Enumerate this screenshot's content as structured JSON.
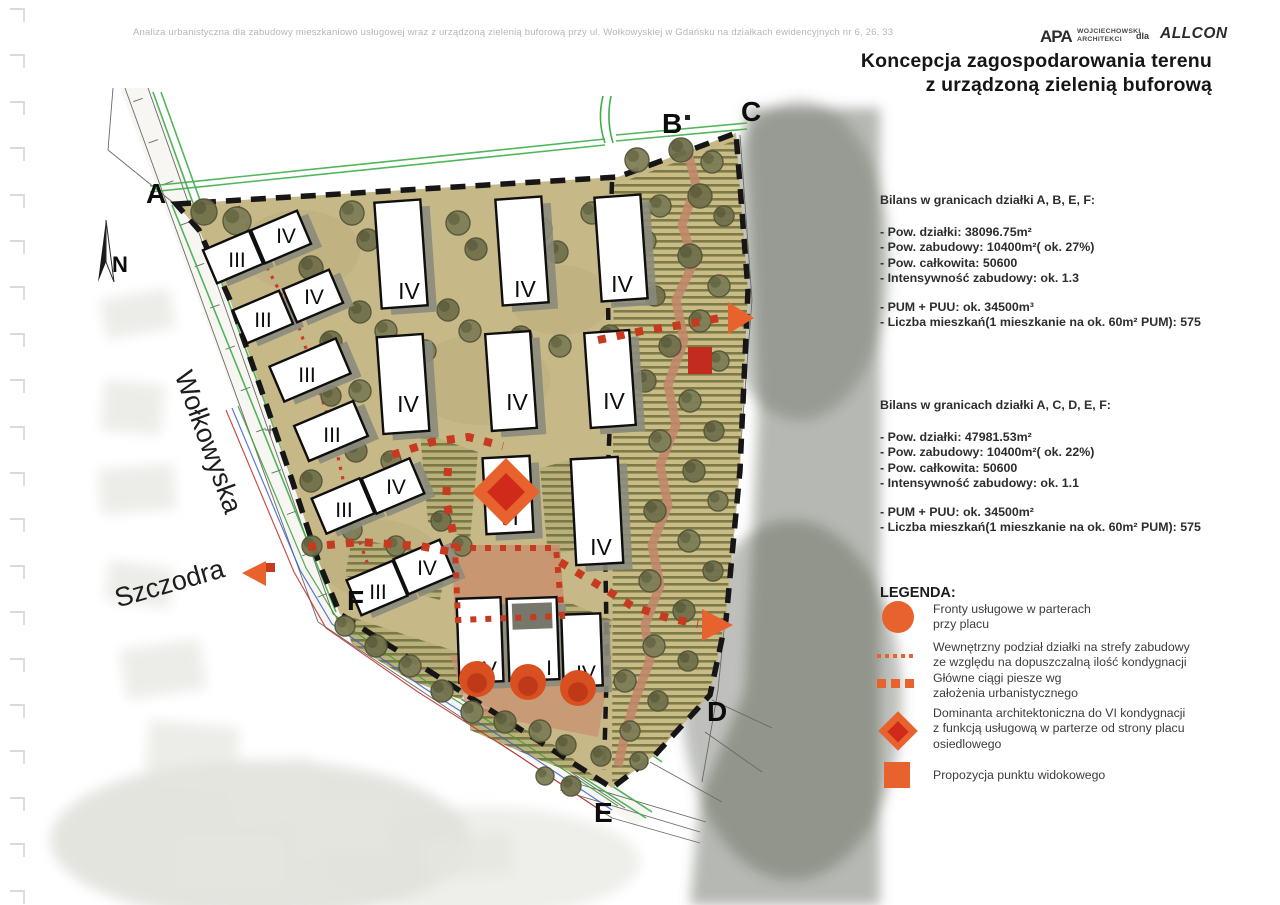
{
  "page": {
    "header_line": "Analiza urbanistyczna dla zabudowy mieszkaniowo usługowej wraz z urządzoną zielenią buforową przy ul. Wołkowyskiej w Gdańsku na działkach ewidencyjnych nr 6, 26, 33",
    "title_line1": "Koncepcja zagospodarowania terenu",
    "title_line2": "z urządzoną zielenią buforową"
  },
  "logos": {
    "apa_mark": "APA",
    "apa_name_line1": "WOJCIECHOWSKI",
    "apa_name_line2": "ARCHITEKCI",
    "dla": "dla",
    "allcon": "ALLCON"
  },
  "bilans_abef": {
    "heading": "Bilans w granicach działki A, B, E, F:",
    "lines1": [
      "- Pow. działki: 38096.75m²",
      "- Pow. zabudowy: 10400m²( ok. 27%)",
      "- Pow. całkowita: 50600",
      "- Intensywność zabudowy: ok. 1.3"
    ],
    "lines2": [
      "- PUM + PUU: ok. 34500m³",
      "- Liczba mieszkań(1 mieszkanie na ok. 60m² PUM): 575"
    ]
  },
  "bilans_acdef": {
    "heading": "Bilans w granicach działki A, C, D, E, F:",
    "lines1": [
      "- Pow. działki: 47981.53m²",
      "- Pow. zabudowy: 10400m²( ok. 22%)",
      "- Pow. całkowita: 50600",
      "- Intensywność zabudowy: ok. 1.1"
    ],
    "lines2": [
      "- PUM + PUU: ok. 34500m²",
      "- Liczba mieszkań(1 mieszkanie na ok. 60m² PUM): 575"
    ]
  },
  "legend": {
    "heading": "LEGENDA:",
    "items": [
      {
        "icon": "service-front-circle-icon",
        "text": "Fronty usługowe w parterach\nprzy placu"
      },
      {
        "icon": "zone-division-dotted-icon",
        "text": "Wewnętrzny podział działki na strefy zabudowy\nze względu na dopuszczalną ilość kondygnacji"
      },
      {
        "icon": "pedestrian-route-dashed-icon",
        "text": "Główne ciągi piesze wg\nzałożenia urbanistycznego"
      },
      {
        "icon": "architectural-dominant-diamond-icon",
        "text": "Dominanta architektoniczna do VI kondygnacji\nz funkcją usługową w parterze od strony placu\nosiedlowego"
      },
      {
        "icon": "viewpoint-square-icon",
        "text": "Propozycja punktu widokowego"
      }
    ]
  },
  "colors": {
    "accent_orange": "#e8622d",
    "accent_red": "#cf2a1a",
    "path_red": "#c63a20",
    "site_tan": "#c7b888",
    "buffer_tan": "#c9bd85",
    "hatch_olive": "#6f6e3e",
    "shadow_gray": "#8b8b7d",
    "tree_dark": "#71714d",
    "tree_light": "#7e7e57",
    "salmon": "#c1876a",
    "green_line": "#3fae4a",
    "boundary_black": "#161616"
  },
  "map": {
    "north_label": "N",
    "plot_labels": [
      {
        "text": "A",
        "x": 146,
        "y": 203
      },
      {
        "text": "B",
        "x": 662,
        "y": 133
      },
      {
        "text": "C",
        "x": 741,
        "y": 121
      },
      {
        "text": "D",
        "x": 707,
        "y": 721
      },
      {
        "text": "E",
        "x": 594,
        "y": 822
      },
      {
        "text": "F",
        "x": 347,
        "y": 610
      }
    ],
    "street_labels": [
      {
        "text": "Wołkowyska",
        "x": 200,
        "y": 445,
        "rot": 70
      },
      {
        "text": "Szczodra",
        "x": 172,
        "y": 592,
        "rot": -16
      }
    ],
    "buildings": [
      {
        "cx": 233,
        "cy": 257,
        "w": 50,
        "h": 36,
        "rot": -23,
        "label": "III",
        "lx": 237,
        "ly": 267,
        "fs": 21
      },
      {
        "cx": 281,
        "cy": 237,
        "w": 50,
        "h": 36,
        "rot": -23,
        "label": "IV",
        "lx": 286,
        "ly": 243,
        "fs": 21
      },
      {
        "cx": 263,
        "cy": 317,
        "w": 50,
        "h": 36,
        "rot": -23,
        "label": "III",
        "lx": 263,
        "ly": 327,
        "fs": 21
      },
      {
        "cx": 313,
        "cy": 296,
        "w": 50,
        "h": 36,
        "rot": -23,
        "label": "IV",
        "lx": 314,
        "ly": 304,
        "fs": 21
      },
      {
        "cx": 310,
        "cy": 370,
        "w": 72,
        "h": 38,
        "rot": -23,
        "label": "III",
        "lx": 307,
        "ly": 382,
        "fs": 21
      },
      {
        "cx": 331,
        "cy": 431,
        "w": 64,
        "h": 38,
        "rot": -23,
        "label": "III",
        "lx": 332,
        "ly": 442,
        "fs": 21
      },
      {
        "cx": 343,
        "cy": 506,
        "w": 52,
        "h": 38,
        "rot": -23,
        "label": "III",
        "lx": 344,
        "ly": 517,
        "fs": 21
      },
      {
        "cx": 393,
        "cy": 486,
        "w": 52,
        "h": 38,
        "rot": -23,
        "label": "IV",
        "lx": 396,
        "ly": 494,
        "fs": 21
      },
      {
        "cx": 377,
        "cy": 588,
        "w": 50,
        "h": 38,
        "rot": -23,
        "label": "III",
        "lx": 378,
        "ly": 599,
        "fs": 21
      },
      {
        "cx": 424,
        "cy": 567,
        "w": 50,
        "h": 38,
        "rot": -23,
        "label": "IV",
        "lx": 427,
        "ly": 575,
        "fs": 21
      },
      {
        "cx": 401,
        "cy": 254,
        "w": 46,
        "h": 106,
        "rot": -4,
        "label": "IV",
        "lx": 409,
        "ly": 299,
        "fs": 23
      },
      {
        "cx": 522,
        "cy": 251,
        "w": 46,
        "h": 106,
        "rot": -4,
        "label": "IV",
        "lx": 525,
        "ly": 297,
        "fs": 23
      },
      {
        "cx": 621,
        "cy": 248,
        "w": 46,
        "h": 104,
        "rot": -4,
        "label": "IV",
        "lx": 622,
        "ly": 292,
        "fs": 23
      },
      {
        "cx": 403,
        "cy": 384,
        "w": 46,
        "h": 97,
        "rot": -4,
        "label": "IV",
        "lx": 408,
        "ly": 412,
        "fs": 23
      },
      {
        "cx": 511,
        "cy": 381,
        "w": 45,
        "h": 97,
        "rot": -4,
        "label": "IV",
        "lx": 517,
        "ly": 410,
        "fs": 23
      },
      {
        "cx": 610,
        "cy": 379,
        "w": 45,
        "h": 95,
        "rot": -4,
        "label": "IV",
        "lx": 614,
        "ly": 409,
        "fs": 23
      },
      {
        "cx": 508,
        "cy": 495,
        "w": 47,
        "h": 76,
        "rot": -3,
        "label": "VI",
        "lx": 508,
        "ly": 525,
        "fs": 23
      },
      {
        "cx": 597,
        "cy": 511,
        "w": 47,
        "h": 106,
        "rot": -3,
        "label": "IV",
        "lx": 601,
        "ly": 555,
        "fs": 23
      },
      {
        "cx": 480,
        "cy": 640,
        "w": 44,
        "h": 84,
        "rot": -2,
        "label": "IV",
        "lx": 487,
        "ly": 676,
        "fs": 21
      },
      {
        "cx": 533,
        "cy": 639,
        "w": 50,
        "h": 82,
        "rot": -2,
        "label": "I",
        "lx": 549,
        "ly": 675,
        "fs": 21,
        "court": true
      },
      {
        "cx": 582,
        "cy": 650,
        "w": 39,
        "h": 72,
        "rot": -2,
        "label": "IV",
        "lx": 586,
        "ly": 680,
        "fs": 21
      }
    ],
    "trees": [
      [
        204,
        212,
        13
      ],
      [
        237,
        221,
        14
      ],
      [
        251,
        247,
        12
      ],
      [
        352,
        213,
        12
      ],
      [
        368,
        240,
        11
      ],
      [
        458,
        223,
        12
      ],
      [
        476,
        249,
        11
      ],
      [
        540,
        229,
        12
      ],
      [
        557,
        252,
        11
      ],
      [
        592,
        213,
        11
      ],
      [
        311,
        268,
        12
      ],
      [
        323,
        300,
        11
      ],
      [
        360,
        312,
        11
      ],
      [
        386,
        331,
        11
      ],
      [
        448,
        310,
        11
      ],
      [
        470,
        331,
        11
      ],
      [
        331,
        342,
        11
      ],
      [
        425,
        351,
        11
      ],
      [
        521,
        337,
        11
      ],
      [
        560,
        346,
        11
      ],
      [
        610,
        336,
        11
      ],
      [
        360,
        391,
        11
      ],
      [
        331,
        396,
        10
      ],
      [
        396,
        420,
        11
      ],
      [
        356,
        451,
        11
      ],
      [
        391,
        461,
        10
      ],
      [
        311,
        481,
        11
      ],
      [
        352,
        530,
        10
      ],
      [
        312,
        546,
        10
      ],
      [
        396,
        546,
        10
      ],
      [
        441,
        521,
        10
      ],
      [
        462,
        546,
        10
      ],
      [
        432,
        571,
        10
      ],
      [
        345,
        626,
        10
      ],
      [
        376,
        646,
        11
      ],
      [
        410,
        666,
        11
      ],
      [
        442,
        691,
        11
      ],
      [
        472,
        712,
        11
      ],
      [
        505,
        722,
        11
      ],
      [
        540,
        731,
        11
      ],
      [
        566,
        745,
        10
      ],
      [
        637,
        160,
        12
      ],
      [
        681,
        150,
        12
      ],
      [
        712,
        162,
        11
      ],
      [
        700,
        196,
        12
      ],
      [
        660,
        206,
        11
      ],
      [
        724,
        216,
        10
      ],
      [
        645,
        241,
        11
      ],
      [
        690,
        256,
        12
      ],
      [
        719,
        286,
        11
      ],
      [
        655,
        296,
        10
      ],
      [
        700,
        321,
        11
      ],
      [
        670,
        346,
        11
      ],
      [
        719,
        361,
        10
      ],
      [
        645,
        381,
        11
      ],
      [
        690,
        401,
        11
      ],
      [
        714,
        431,
        10
      ],
      [
        660,
        441,
        11
      ],
      [
        694,
        471,
        11
      ],
      [
        718,
        501,
        10
      ],
      [
        655,
        511,
        11
      ],
      [
        689,
        541,
        11
      ],
      [
        713,
        571,
        10
      ],
      [
        650,
        581,
        11
      ],
      [
        684,
        611,
        11
      ],
      [
        654,
        646,
        11
      ],
      [
        688,
        661,
        10
      ],
      [
        625,
        681,
        11
      ],
      [
        658,
        701,
        10
      ],
      [
        630,
        731,
        10
      ],
      [
        601,
        756,
        10
      ],
      [
        639,
        761,
        9
      ],
      [
        571,
        786,
        10
      ],
      [
        545,
        776,
        9
      ]
    ],
    "service_circles": [
      [
        477,
        679,
        18
      ],
      [
        528,
        682,
        18
      ],
      [
        578,
        688,
        18
      ]
    ],
    "dominant_diamond": {
      "cx": 506,
      "cy": 492,
      "r_outer": 34,
      "r_inner": 19
    },
    "viewpoint_square": {
      "x": 688,
      "y": 347,
      "w": 24,
      "h": 27
    },
    "direction_arrows": [
      {
        "points": "728,302 754,318 728,334"
      },
      {
        "points": "702,609 733,625 702,641"
      },
      {
        "points": "266,561 242,573 266,586"
      }
    ],
    "crosses": [
      [
        497,
        218
      ],
      [
        388,
        333
      ],
      [
        614,
        521
      ],
      [
        424,
        622
      ],
      [
        712,
        482
      ],
      [
        270,
        430
      ]
    ]
  }
}
